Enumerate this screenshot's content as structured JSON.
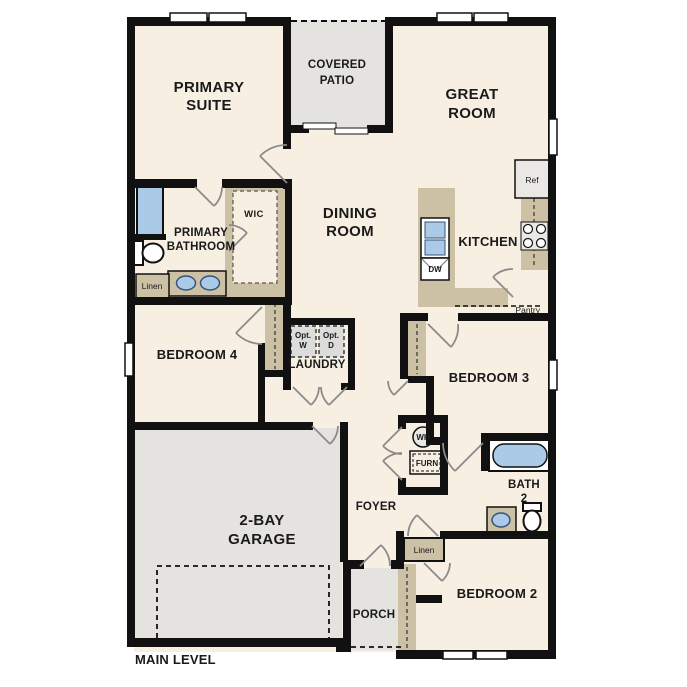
{
  "plan": {
    "title": "MAIN LEVEL",
    "rooms": {
      "primary_suite": {
        "line1": "PRIMARY",
        "line2": "SUITE"
      },
      "covered_patio": {
        "line1": "COVERED",
        "line2": "PATIO"
      },
      "great_room": {
        "line1": "GREAT",
        "line2": "ROOM"
      },
      "primary_bathroom": {
        "line1": "PRIMARY",
        "line2": "BATHROOM"
      },
      "wic": {
        "label": "WIC"
      },
      "dining_room": {
        "line1": "DINING",
        "line2": "ROOM"
      },
      "kitchen": {
        "label": "KITCHEN"
      },
      "pantry": {
        "label": "Pantry"
      },
      "bedroom4": {
        "label": "BEDROOM 4"
      },
      "laundry": {
        "label": "LAUNDRY"
      },
      "bedroom3": {
        "label": "BEDROOM 3"
      },
      "garage": {
        "line1": "2-BAY",
        "line2": "GARAGE"
      },
      "foyer": {
        "label": "FOYER"
      },
      "bath2": {
        "line1": "BATH",
        "line2": "2"
      },
      "porch": {
        "label": "PORCH"
      },
      "bedroom2": {
        "label": "BEDROOM 2"
      }
    },
    "fixtures": {
      "ref": {
        "label": "Ref"
      },
      "dw": {
        "label": "DW"
      },
      "opt_washer": {
        "line1": "Opt.",
        "line2": "W"
      },
      "opt_dryer": {
        "line1": "Opt.",
        "line2": "D"
      },
      "wh": {
        "label": "WH"
      },
      "furnace": {
        "label": "FURN"
      },
      "linen_bath": {
        "label": "Linen"
      },
      "linen_hall": {
        "label": "Linen"
      }
    },
    "colors": {
      "floor": "#f7efe2",
      "outdoor": "#e4e3df",
      "cabinet": "#cdc1a5",
      "fixture_blue": "#abcae8",
      "wall": "#111111",
      "appliance": "#e9e8e5"
    }
  }
}
